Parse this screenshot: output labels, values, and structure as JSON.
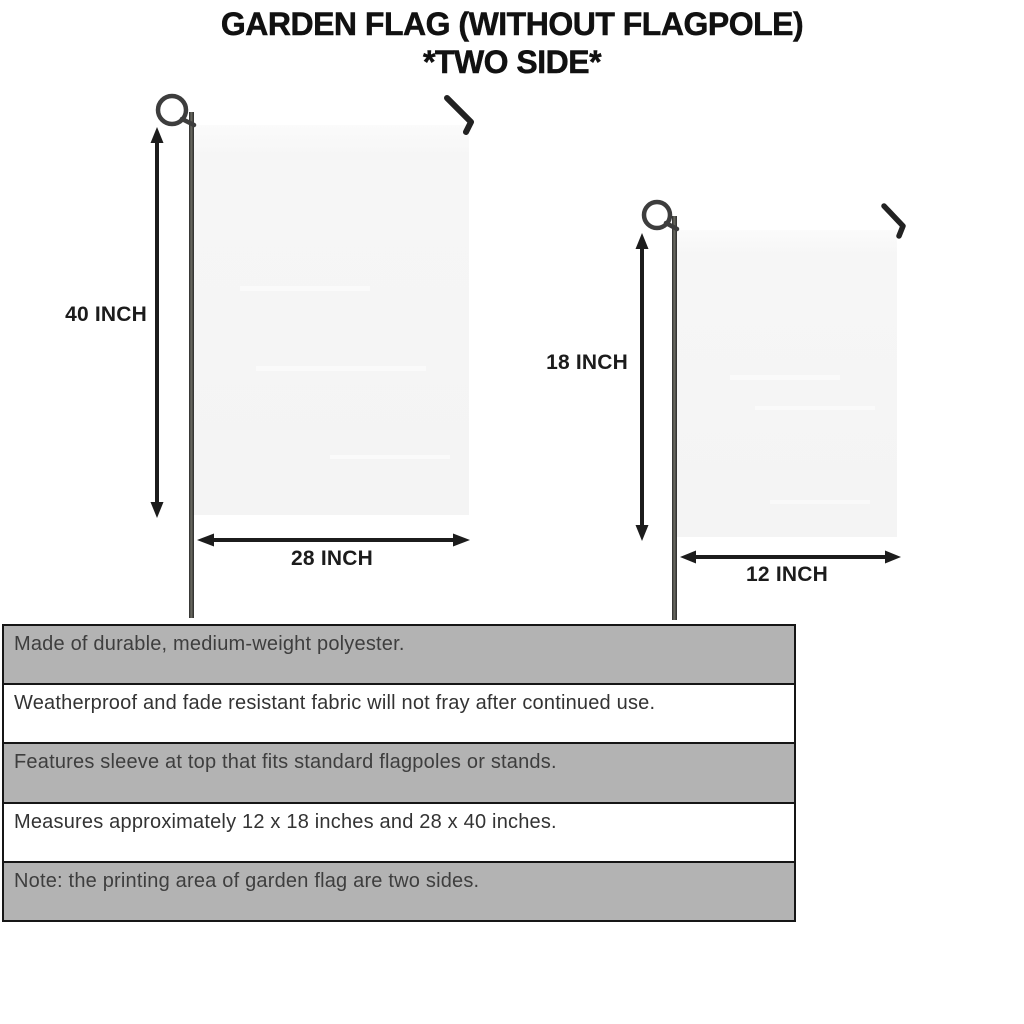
{
  "title": {
    "line1": "GARDEN FLAG (WITHOUT FLAGPOLE)",
    "line2": "*TWO SIDE*"
  },
  "flags": {
    "large": {
      "height_label": "40 INCH",
      "width_label": "28 INCH"
    },
    "small": {
      "height_label": "18 INCH",
      "width_label": "12 INCH"
    }
  },
  "features": [
    "Made of durable, medium-weight polyester.",
    "Weatherproof and fade resistant fabric will not fray after continued use.",
    "Features sleeve at top that fits standard flagpoles or stands.",
    "Measures approximately 12 x 18 inches and 28 x 40 inches.",
    "Note: the printing area of garden flag are two sides."
  ],
  "colors": {
    "row_gray": "#b3b3b3",
    "row_white": "#ffffff",
    "table_border": "#161616",
    "flag_fill": "#f6f6f6",
    "pole_dark": "#333333",
    "ink": "#1c1c1c",
    "feature_text": "#3c3c3c"
  }
}
